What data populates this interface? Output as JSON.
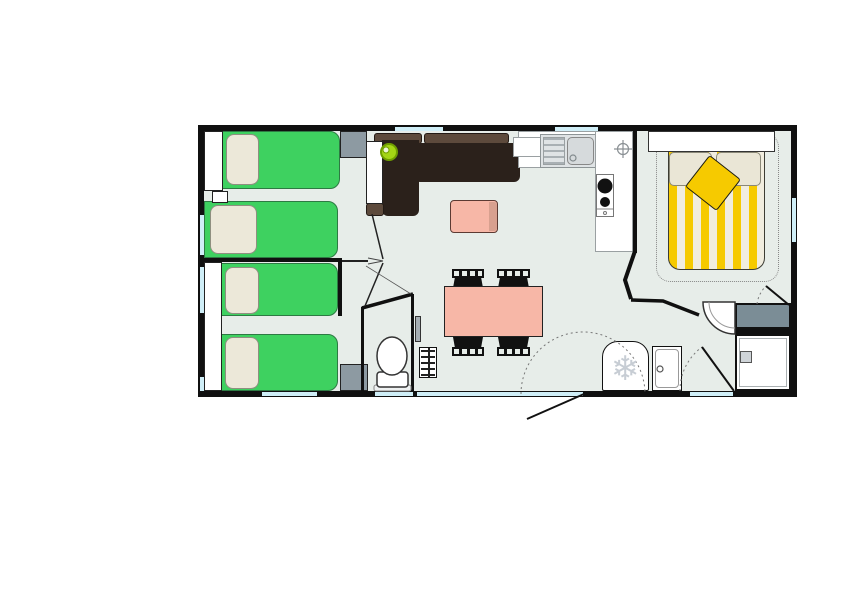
{
  "meta": {
    "type": "mobile-home-floor-plan",
    "canvas_w": 843,
    "canvas_h": 596
  },
  "palette": {
    "wall": "#101010",
    "floor": "#e7ede9",
    "window": "#cfeef7",
    "bed_green": "#3ed160",
    "pillow": "#ece8d9",
    "pillow_border": "#8f8f80",
    "sofa_dark": "#2b211b",
    "sofa_brown": "#5d4a3c",
    "coral": "#f7b7a7",
    "coral_dark": "#d8a08f",
    "yellow": "#f6ca00",
    "duvet_base": "#f1eddf",
    "cream": "#eae6d6",
    "slate": "#8d9aa2",
    "slate_dark": "#7b8d96",
    "lamp": "#a4d515",
    "lamp_dark": "#6f9e00",
    "appliance_icon": "#c7cdd4",
    "sink_gray": "#dfe3e5",
    "sink_bowl": "#d6dadc",
    "chair_black": "#111111",
    "dash": "#777777"
  },
  "icons": {
    "snowflake": "❄"
  },
  "rooms": [
    {
      "name": "bedroom-twin-1",
      "beds": 2
    },
    {
      "name": "bedroom-twin-2",
      "beds": 2
    },
    {
      "name": "wc",
      "fixtures": [
        "toilet"
      ]
    },
    {
      "name": "living-dining",
      "furniture": [
        "corner-sofa",
        "coffee-table",
        "dining-table",
        "chairs-x4",
        "lamp",
        "radiator-shelf"
      ]
    },
    {
      "name": "kitchen",
      "fixtures": [
        "sink-with-drainer",
        "two-burner-stove",
        "counter",
        "ceiling-light-symbol"
      ]
    },
    {
      "name": "master-bedroom",
      "furniture": [
        "double-bed",
        "headboard",
        "cushion"
      ]
    },
    {
      "name": "shower-room",
      "fixtures": [
        "corner-washbasin",
        "vanity",
        "shower-tray",
        "fridge",
        "cabinet"
      ]
    }
  ],
  "counts": {
    "single_beds": 4,
    "double_beds": 1,
    "dining_chairs": 4,
    "windows": 10,
    "doors": 6
  }
}
